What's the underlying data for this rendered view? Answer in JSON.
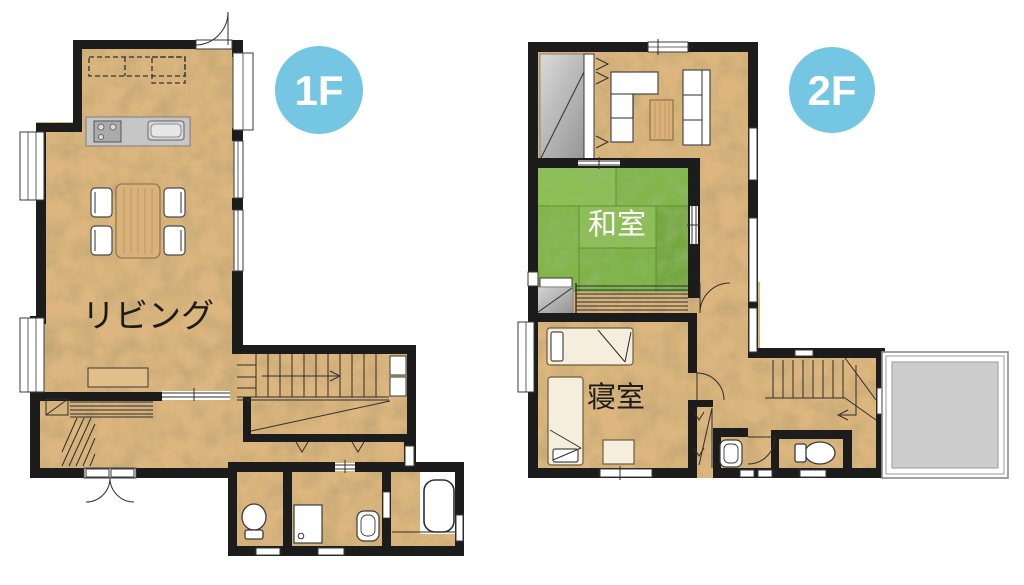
{
  "floors": {
    "f1": {
      "badge": "1F",
      "room_labels": {
        "living": "リビング"
      }
    },
    "f2": {
      "badge": "2F",
      "room_labels": {
        "japanese_room": "和室",
        "bedroom": "寝室"
      }
    }
  },
  "colors": {
    "background": "#ffffff",
    "wall": "#1c1c1c",
    "floor_wood": "#dcb67e",
    "tatami_light": "#8cbf55",
    "tatami_dark": "#7cb046",
    "floor_badge": "#74c6e2",
    "badge_text": "#ffffff",
    "kitchen_counter": "#c6c6c6",
    "balcony_gray": "#cdcdcd",
    "living_label_color": "#1c1c1c",
    "washitsu_label_color": "#ffffff",
    "bedroom_label_color": "#1c1c1c"
  },
  "icon_legend": [
    "stove-icon",
    "kitchen-sink-icon",
    "dining-table",
    "chair",
    "tv-board",
    "stairs-up",
    "stairs-down",
    "entrance-door",
    "toilet-icon",
    "washbasin-icon",
    "washing-machine-icon",
    "bathtub-icon",
    "tatami-mats",
    "sofa",
    "low-table",
    "bed",
    "desk",
    "closet",
    "window",
    "door-arc",
    "balcony"
  ]
}
